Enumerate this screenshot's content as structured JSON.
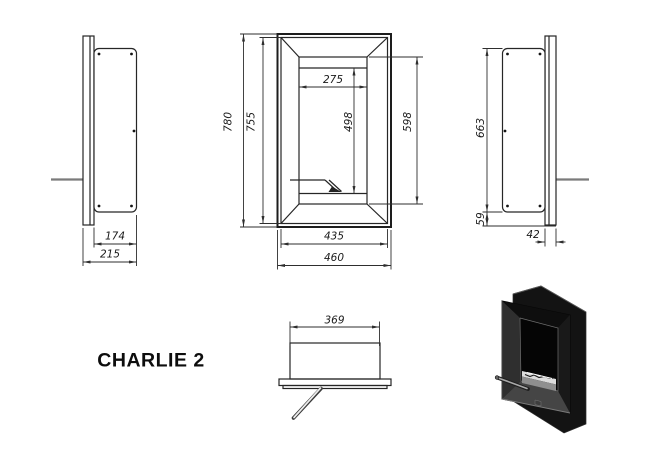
{
  "title": "CHARLIE 2",
  "views": {
    "left_side": {
      "label": "left-side-section-view",
      "dims": {
        "body_depth": "174",
        "total_depth": "215"
      }
    },
    "front": {
      "label": "front-view",
      "dims": {
        "outer_height": "780",
        "frame_height": "755",
        "opening_width": "275",
        "glass_height": "498",
        "opening_height": "598",
        "frame_width": "435",
        "outer_width": "460"
      }
    },
    "right_side": {
      "label": "right-side-section-view",
      "dims": {
        "body_height": "663",
        "bottom_inset": "59",
        "frame_depth": "42"
      }
    },
    "top": {
      "label": "top-section-view",
      "dims": {
        "body_width": "369"
      }
    },
    "render_3d": {
      "label": "product-photo-black-recessed-biofireplace"
    }
  },
  "colors": {
    "background": "#ffffff",
    "drawing_line": "#262626",
    "dimension_line": "#2e2e2e",
    "wall_line": "#7b7b7b",
    "label_text": "#1a1a1a",
    "render_black": "#161616",
    "render_bevel_light": "#454545",
    "burner_metal": "#dcdcdc"
  }
}
